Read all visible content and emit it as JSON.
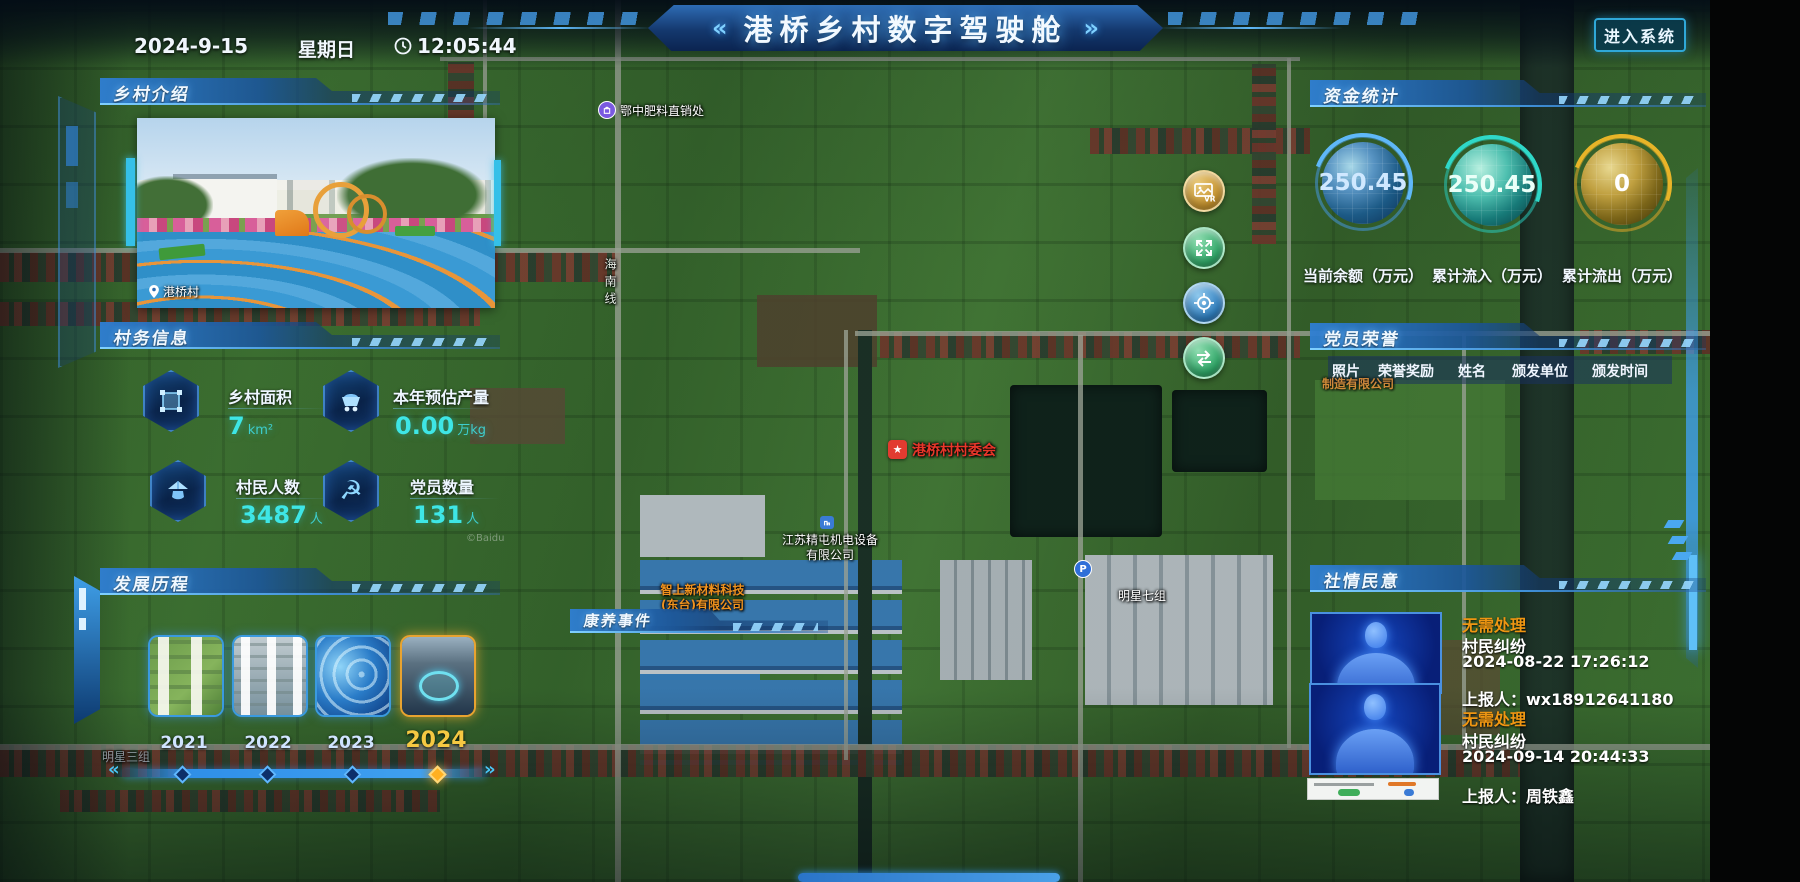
{
  "header": {
    "title": "港桥乡村数字驾驶舱",
    "chev_left": "«",
    "chev_right": "»",
    "date": "2024-9-15",
    "weekday": "星期日",
    "time": "12:05:44",
    "enter_button": "进入系统"
  },
  "village_intro": {
    "title": "乡村介绍",
    "photo_location": "港桥村"
  },
  "village_info": {
    "title": "村务信息",
    "stats": [
      {
        "icon": "area-select-icon",
        "label": "乡村面积",
        "value": "7",
        "unit": "km²"
      },
      {
        "icon": "mine-cart-icon",
        "label": "本年预估产量",
        "value": "0.00",
        "unit": "万kg"
      },
      {
        "icon": "farmer-hat-icon",
        "label": "村民人数",
        "value": "3487",
        "unit": "人"
      },
      {
        "icon": "hammer-sickle-icon",
        "label": "党员数量",
        "value": "131",
        "unit": "人"
      }
    ]
  },
  "development": {
    "title": "发展历程",
    "years": [
      "2021",
      "2022",
      "2023",
      "2024"
    ],
    "active_year": "2024",
    "prev_arrow": "«",
    "next_arrow": "»"
  },
  "funds": {
    "title": "资金统计",
    "gauges": [
      {
        "value": "250.45",
        "label": "当前余额（万元）",
        "color": "#4a9fe8"
      },
      {
        "value": "250.45",
        "label": "累计流入（万元）",
        "color": "#2fd8c8"
      },
      {
        "value": "0",
        "label": "累计流出（万元）",
        "color": "#d9a520"
      }
    ]
  },
  "party_honors": {
    "title": "党员荣誉",
    "columns": [
      "照片",
      "荣誉奖励",
      "姓名",
      "颁发单位",
      "颁发时间"
    ]
  },
  "sentiment": {
    "title": "社情民意",
    "status_color": "#ef9612",
    "items": [
      {
        "status": "无需处理",
        "type": "村民纠纷",
        "time": "2024-08-22 17:26:12",
        "reporter": "上报人：wx18912641180"
      },
      {
        "status": "无需处理",
        "type": "村民纠纷",
        "time": "2024-09-14 20:44:33",
        "reporter": "上报人：周铁鑫"
      }
    ]
  },
  "map": {
    "event_bar": "康养事件",
    "vr_label": "VR",
    "labels": {
      "fertilizer": "鄂中肥料直销处",
      "road": "海南线",
      "committee": "港桥村村委会",
      "company1_line1": "江苏精屯机电设备",
      "company1_line2": "有限公司",
      "company2_line1": "智上新材料科技",
      "company2_line2": "(东台)有限公司",
      "company3_partial": "制造有限公司",
      "group7": "明星七组",
      "group3": "明星三组",
      "parking": "P",
      "copyright": "©Baidu"
    },
    "controls": [
      "vr-panorama",
      "fullscreen-expand",
      "locate-target",
      "layer-switch"
    ]
  }
}
